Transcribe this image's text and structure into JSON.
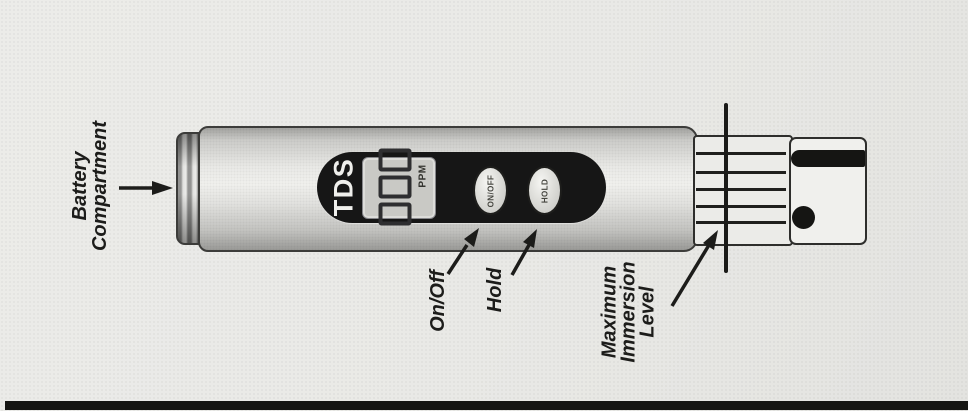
{
  "figure": {
    "background": "#e9e9e6",
    "ink": "#1c1c1a",
    "bottom_rule_color": "#151513"
  },
  "device": {
    "brand": "TDS",
    "display": {
      "value": "000",
      "unit": "PPM"
    },
    "buttons": {
      "power": "ON/OFF",
      "hold": "HOLD"
    },
    "colors": {
      "faceplate": "#161616",
      "lcd": "#c9c9c5",
      "body": "#dcdcd9",
      "electrode": "#151513"
    }
  },
  "callouts": {
    "battery": {
      "line1": "Battery",
      "line2": "Compartment"
    },
    "power": {
      "label": "On/Off"
    },
    "hold": {
      "label": "Hold"
    },
    "immersion": {
      "line1": "Maximum",
      "line2": "Immersion",
      "line3": "Level"
    }
  }
}
